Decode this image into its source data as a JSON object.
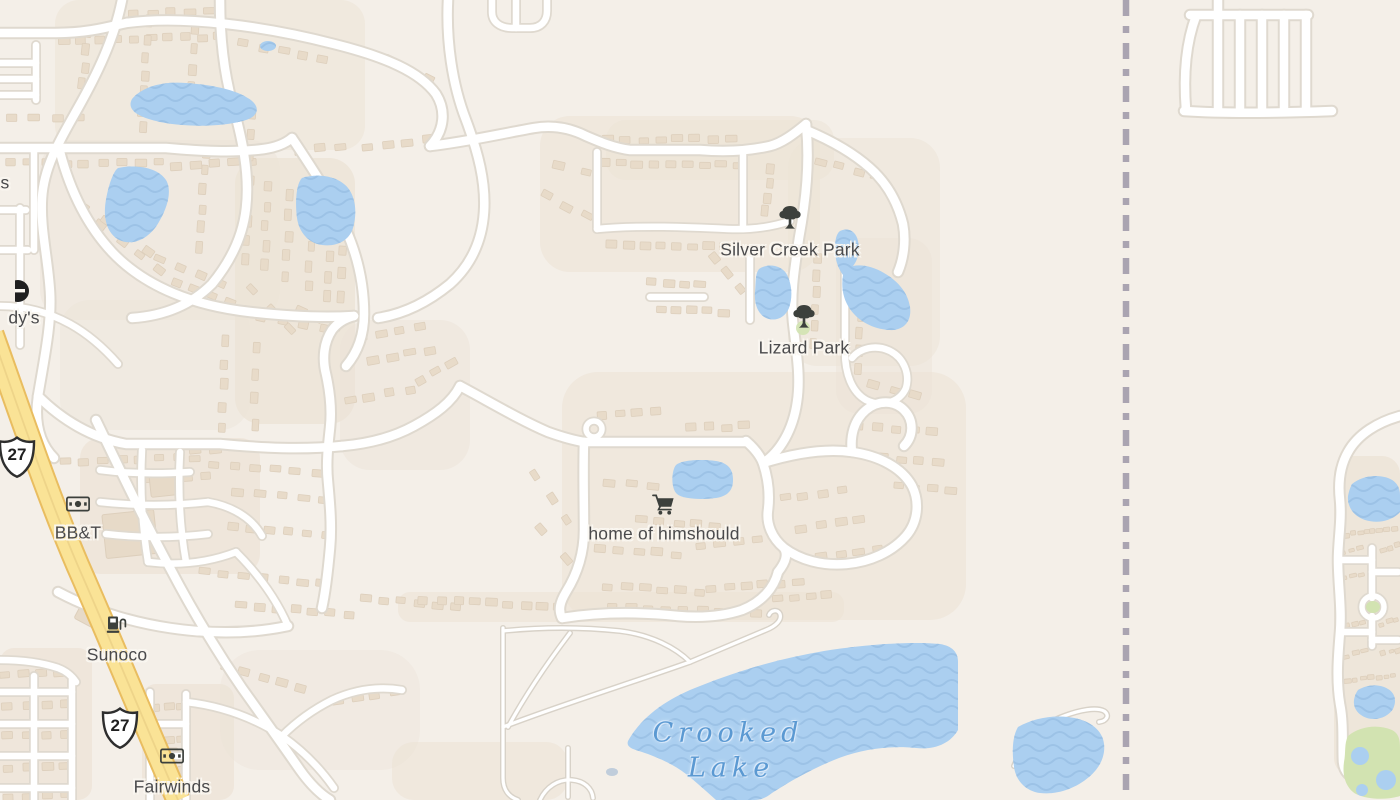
{
  "map": {
    "type_label": "street-map",
    "colors": {
      "background": "#f4efe8",
      "residential": "#ece3d6",
      "road_fill": "#ffffff",
      "road_casing": "#dfd9cf",
      "highway_fill": "#fae396",
      "highway_casing": "#e9bd60",
      "water": "#abcff0",
      "water_wave": "#9cc2e6",
      "water_label": "#5b99d2",
      "park_green": "#d2e3b1",
      "building": "#e8dbc9",
      "poi_label": "#4a4a4c",
      "poi_icon": "#3c403c",
      "boundary": "#9e97a8"
    },
    "pois": [
      {
        "label": "Silver Creek Park",
        "icon": "tree-icon",
        "x": 790,
        "y": 250,
        "icon_y": 219
      },
      {
        "label": "Lizard Park",
        "icon": "tree-icon",
        "x": 804,
        "y": 348,
        "icon_y": 318
      },
      {
        "label": "home of himshould",
        "icon": "shopping-cart-icon",
        "x": 664,
        "y": 534,
        "icon_y": 505
      },
      {
        "label": "BB&T",
        "icon": "bank-icon",
        "x": 78,
        "y": 533,
        "icon_y": 504
      },
      {
        "label": "Sunoco",
        "icon": "fuel-icon",
        "x": 117,
        "y": 655,
        "icon_y": 624
      },
      {
        "label": "Fairwinds",
        "icon": "bank-icon",
        "x": 172,
        "y": 787,
        "icon_y": 756
      },
      {
        "label": "s",
        "x": 5,
        "y": 183
      },
      {
        "label": "dy's",
        "icon": "partial-logo-icon",
        "x": 24,
        "y": 318,
        "icon_y": 291
      }
    ],
    "water_labels": [
      {
        "label": "Crooked",
        "x": 728,
        "y": 733
      },
      {
        "label": "Lake",
        "x": 731,
        "y": 768
      }
    ],
    "shields": [
      {
        "route": "27",
        "x": 17,
        "y": 457
      },
      {
        "route": "27",
        "x": 120,
        "y": 728
      }
    ]
  }
}
